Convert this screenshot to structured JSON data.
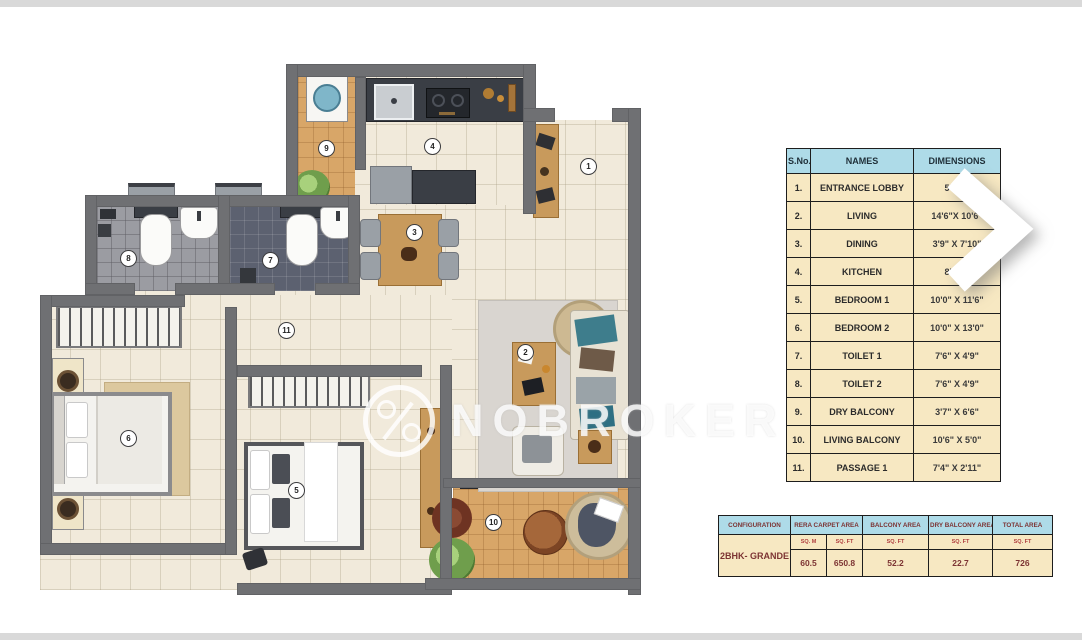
{
  "watermark": {
    "brand": "NOBROKER",
    "logo_icon": "percent-circle"
  },
  "carousel": {
    "next_arrow_icon": "chevron-right"
  },
  "plan": {
    "markers": [
      "1",
      "2",
      "3",
      "4",
      "5",
      "6",
      "7",
      "8",
      "9",
      "10",
      "11"
    ]
  },
  "rooms_table": {
    "headers": {
      "sno": "S.No.",
      "names": "NAMES",
      "dimensions": "DIMENSIONS"
    },
    "rows": [
      {
        "sno": "1.",
        "name": "ENTRANCE LOBBY",
        "dim": "5'1\" X"
      },
      {
        "sno": "2.",
        "name": "LIVING",
        "dim": "14'6\"X 10'6\""
      },
      {
        "sno": "3.",
        "name": "DINING",
        "dim": "3'9\" X 7'10\""
      },
      {
        "sno": "4.",
        "name": "KITCHEN",
        "dim": "8'6\" X"
      },
      {
        "sno": "5.",
        "name": "BEDROOM 1",
        "dim": "10'0\" X 11'6\""
      },
      {
        "sno": "6.",
        "name": "BEDROOM 2",
        "dim": "10'0\" X 13'0\""
      },
      {
        "sno": "7.",
        "name": "TOILET 1",
        "dim": "7'6\" X 4'9\""
      },
      {
        "sno": "8.",
        "name": "TOILET 2",
        "dim": "7'6\" X 4'9\""
      },
      {
        "sno": "9.",
        "name": "DRY BALCONY",
        "dim": "3'7\" X 6'6\""
      },
      {
        "sno": "10.",
        "name": "LIVING BALCONY",
        "dim": "10'6\" X 5'0\""
      },
      {
        "sno": "11.",
        "name": "PASSAGE 1",
        "dim": "7'4\" X 2'11\""
      }
    ]
  },
  "config_table": {
    "headers": {
      "configuration": "CONFIGURATION",
      "rera": "RERA CARPET AREA",
      "balcony": "BALCONY AREA",
      "dry_balcony": "DRY BALCONY AREA",
      "total": "TOTAL AREA"
    },
    "unit_labels": {
      "sqm": "SQ. M",
      "sqft": "SQ. FT"
    },
    "row": {
      "configuration": "2BHK- GRANDE",
      "rera_sqm": "60.5",
      "rera_sqft": "650.8",
      "balcony_sqft": "52.2",
      "dry_balcony_sqft": "22.7",
      "total_sqft": "726"
    }
  },
  "colors": {
    "table_header_blue": "#AEDBE8",
    "table_body_cream": "#F7E8C2",
    "config_text_maroon": "#7C3333",
    "wall_grey": "#6F7073",
    "floor_cream": "#F1EADB",
    "balcony_orange": "#D8A668",
    "toilet1_tile": "#5C6170",
    "toilet2_tile": "#9B9CA2"
  }
}
